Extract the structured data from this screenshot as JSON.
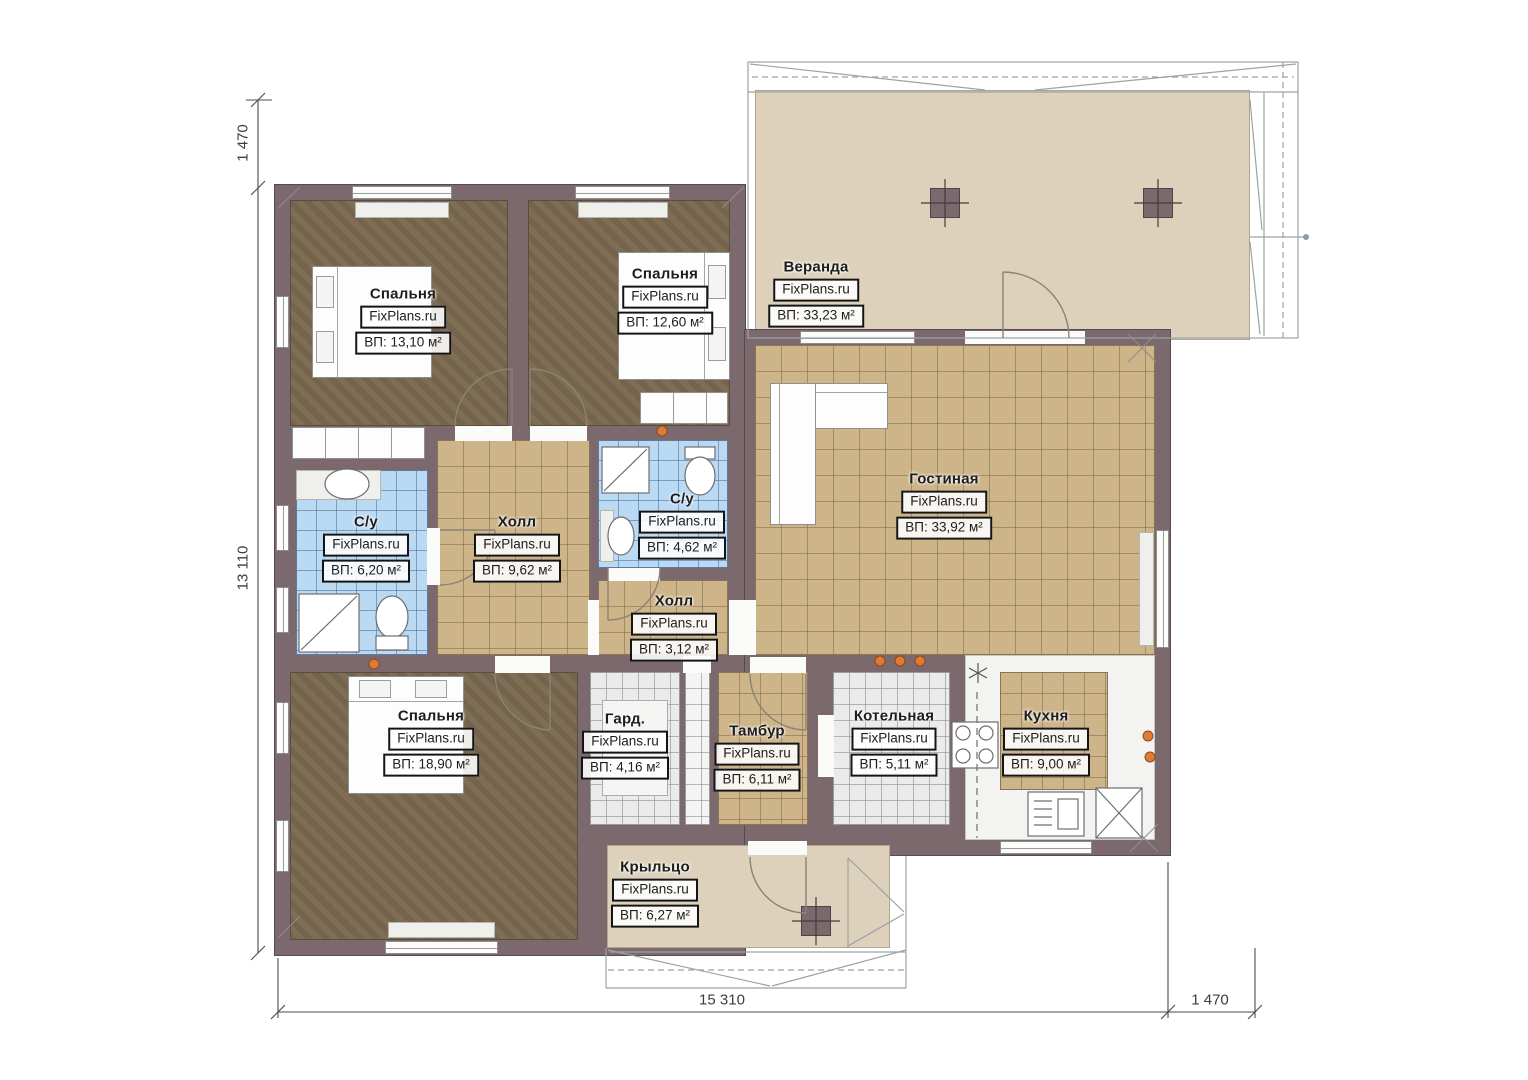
{
  "watermark": "FixPlans.ru",
  "dimensions": {
    "left_top": "1 470",
    "left_side": "13 110",
    "bottom_width": "15 310",
    "bottom_right": "1 470"
  },
  "rooms": [
    {
      "id": "bedroom-1",
      "name": "Спальня",
      "area": "ВП: 13,10 м²"
    },
    {
      "id": "bedroom-2",
      "name": "Спальня",
      "area": "ВП: 12,60 м²"
    },
    {
      "id": "veranda",
      "name": "Веранда",
      "area": "ВП: 33,23 м²"
    },
    {
      "id": "living",
      "name": "Гостиная",
      "area": "ВП: 33,92 м²"
    },
    {
      "id": "bath-1",
      "name": "С/у",
      "area": "ВП: 6,20 м²"
    },
    {
      "id": "hall-1",
      "name": "Холл",
      "area": "ВП: 9,62 м²"
    },
    {
      "id": "bath-2",
      "name": "С/у",
      "area": "ВП: 4,62 м²"
    },
    {
      "id": "hall-2",
      "name": "Холл",
      "area": "ВП: 3,12 м²"
    },
    {
      "id": "bedroom-3",
      "name": "Спальня",
      "area": "ВП: 18,90 м²"
    },
    {
      "id": "wardrobe",
      "name": "Гард.",
      "area": "ВП: 4,16 м²"
    },
    {
      "id": "tambour",
      "name": "Тамбур",
      "area": "ВП: 6,11 м²"
    },
    {
      "id": "boiler",
      "name": "Котельная",
      "area": "ВП: 5,11 м²"
    },
    {
      "id": "kitchen",
      "name": "Кухня",
      "area": "ВП: 9,00 м²"
    },
    {
      "id": "porch",
      "name": "Крыльцо",
      "area": "ВП: 6,27 м²"
    }
  ]
}
